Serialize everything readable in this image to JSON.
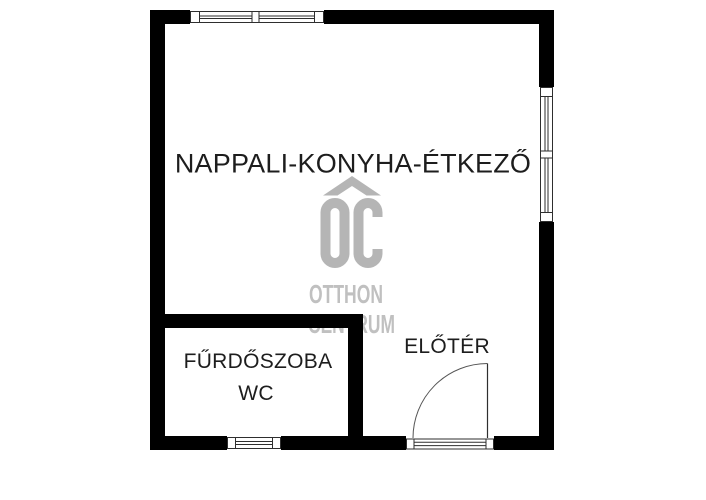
{
  "watermark": {
    "logo": "OC",
    "line1": "OTTHON",
    "line2": "CENTRUM"
  },
  "rooms": {
    "living_kitchen_dining": {
      "label": "NAPPALI-KONYHA-ÉTKEZŐ"
    },
    "bathroom": {
      "label": "FŰRDŐSZOBA",
      "sublabel": "WC"
    },
    "hallway": {
      "label": "ELŐTÉR"
    }
  },
  "colors": {
    "background": "#ffffff",
    "wall": "#000000",
    "thin_line": "#2e2e2e",
    "text": "#1d1d1d",
    "watermark_logo": "#b5b5b5",
    "watermark_text": "#c0c0c0"
  }
}
